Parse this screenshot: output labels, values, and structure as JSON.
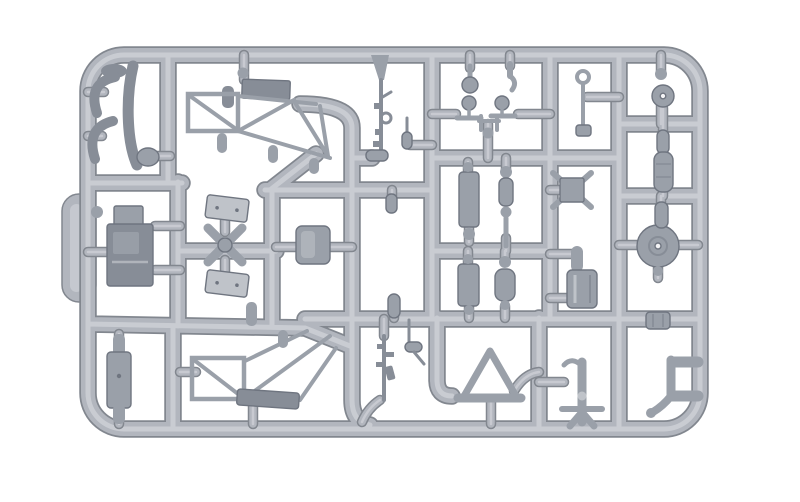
{
  "image": {
    "type": "photograph",
    "subject": "Light grey injection-moulded plastic model kit sprue (parts runner tree) with small scale-model parts, photographed on a plain white background",
    "background_color": "#ffffff"
  },
  "palette": {
    "background": "#ffffff",
    "runner_shadow": "#82878f",
    "runner_base": "#b2b6be",
    "runner_highlight": "#cdd0d6",
    "part_fill": "#9aa0a9",
    "part_dark": "#878d97",
    "part_light": "#bfc3c9",
    "outline": "#6f7580",
    "hole": "#f4f4f6"
  },
  "sprue": {
    "frame": "rounded rectangular outer runner frame with internal cross runners dividing the tree into cells; moulding gates join each part to the runners",
    "material": "grey polystyrene",
    "parts": [
      {
        "name": "mudguard-fender-set",
        "desc": "curved mudguard halves and narrow fender strip"
      },
      {
        "name": "engine-block",
        "desc": "small rectangular engine block"
      },
      {
        "name": "four-blade-propeller",
        "desc": "X shaped four blade propeller with hub"
      },
      {
        "name": "drilled-plates",
        "desc": "two flat plates each with two small holes"
      },
      {
        "name": "upper-truss-chassis-frame",
        "desc": "open triangulated chassis frame with solid top plate"
      },
      {
        "name": "lower-truss-chassis-frame",
        "desc": "open triangulated chassis frame with solid bottom bar"
      },
      {
        "name": "rifle",
        "desc": "small rifle with ring sight and bolt details"
      },
      {
        "name": "rod-antenna",
        "desc": "thin rod antenna with tapered body"
      },
      {
        "name": "fuel-tank",
        "desc": "rounded square tank block"
      },
      {
        "name": "handlebars-with-mirrors",
        "desc": "two handlebar pieces with round mirrors and linkage"
      },
      {
        "name": "round-head-peg",
        "desc": "peg with spherical head"
      },
      {
        "name": "hook-peg",
        "desc": "peg with hooked tip"
      },
      {
        "name": "suspension-cylinder-set",
        "desc": "capsule and bead shaped suspension cylinders"
      },
      {
        "name": "ribbed-cylinder",
        "desc": "short grooved cylinder"
      },
      {
        "name": "warning-triangle-gusset",
        "desc": "hollow triangular gusset on base bar"
      },
      {
        "name": "eyelet-lever",
        "desc": "thin lever with eyelet ring"
      },
      {
        "name": "square-hub-propeller",
        "desc": "square hub with X blades"
      },
      {
        "name": "canister",
        "desc": "wide canister with capped neck"
      },
      {
        "name": "pedestal-mount",
        "desc": "pedestal mount with crossbar and splayed feet"
      },
      {
        "name": "hub-disc",
        "desc": "large round disc with centre hole and ring"
      },
      {
        "name": "eye-ball-fitting",
        "desc": "ball fitting with small through hole"
      },
      {
        "name": "l-bracket",
        "desc": "L shaped bracket with curved foot"
      },
      {
        "name": "coupler-sleeve",
        "desc": "small ridged sleeve on runner"
      },
      {
        "name": "second-rifle",
        "desc": "rifle with magazine moulded near bottom rail"
      },
      {
        "name": "foot-pedal",
        "desc": "small pedal on thin rod"
      },
      {
        "name": "floor-slab",
        "desc": "long flat slab with end nubs"
      },
      {
        "name": "small-nubs-and-pegs",
        "desc": "assorted small capsule nubs and pegs"
      }
    ]
  }
}
